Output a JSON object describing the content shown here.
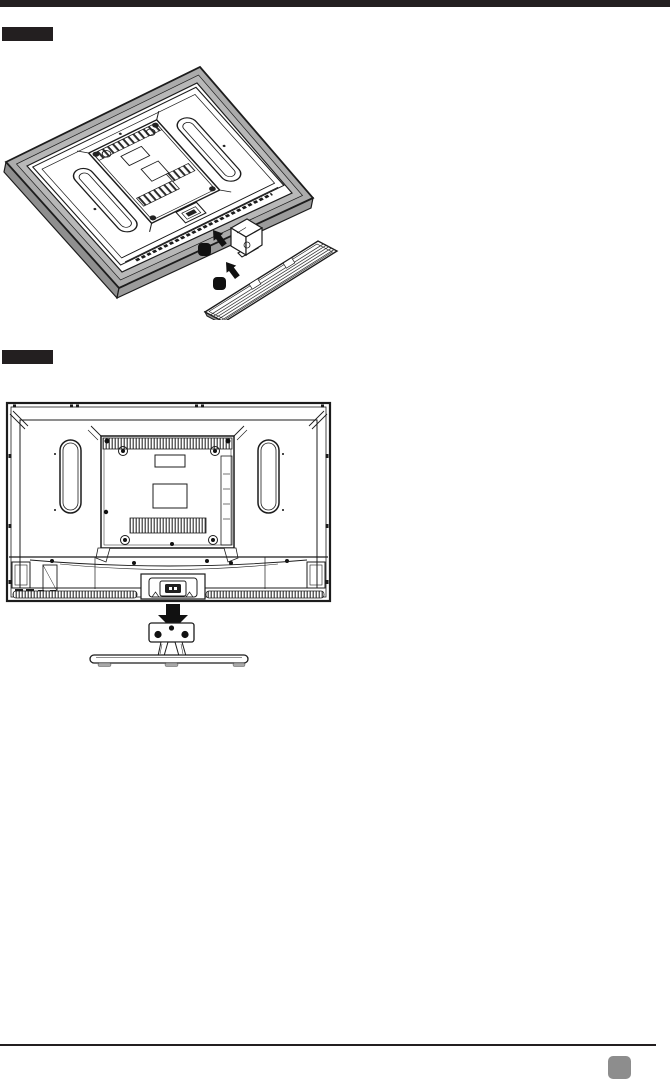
{
  "page": {
    "background": "#ffffff",
    "colors": {
      "ink": "#1c1c1c",
      "top_bar": "#231f20",
      "step_label_bg": "#231f20",
      "tv_bezel_gray": "#ababab",
      "footer_rule": "#231f20",
      "page_badge": "#8d8d8d"
    }
  },
  "steps": [
    {
      "label_text": "",
      "figure_name": "tv-rear-perspective-stand-detached",
      "icons": [
        "attach-arrow-icon",
        "screw-icon",
        "stand-neck",
        "stand-base-plate"
      ]
    },
    {
      "label_text": "",
      "figure_name": "tv-rear-view-stand-below",
      "icons": [
        "down-arrow-icon",
        "screw-icon",
        "stand-bracket",
        "stand-base"
      ]
    }
  ],
  "footer": {
    "badge_text": ""
  }
}
